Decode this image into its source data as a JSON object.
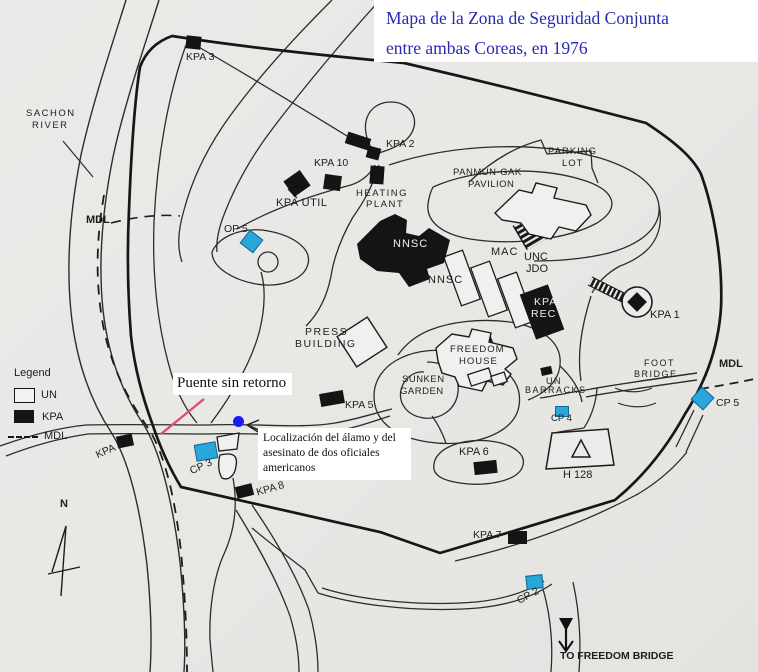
{
  "title": {
    "line1": "Mapa de la Zona de Seguridad Conjunta",
    "line2": "entre ambas Coreas, en 1976"
  },
  "legend": {
    "heading": "Legend",
    "un": "UN",
    "kpa": "KPA",
    "mdl": "MDL"
  },
  "compass": {
    "north": "N"
  },
  "annotations": {
    "bridge_label": "Puente sin retorno",
    "incident_line1": "Localización del álamo y del",
    "incident_line2": "asesinato de dos oficiales",
    "incident_line3": "americanos"
  },
  "labels": {
    "kpa1": "KPA 1",
    "kpa2": "KPA 2",
    "kpa3": "KPA 3",
    "kpa4": "KPA 4",
    "kpa5": "KPA 5",
    "kpa6": "KPA 6",
    "kpa7": "KPA 7",
    "kpa8": "KPA 8",
    "kpa10": "KPA 10",
    "kpa_util": "KPA UTIL",
    "op5": "OP 5",
    "cp2": "CP 2",
    "cp3": "CP 3",
    "cp4": "CP 4",
    "cp5": "CP 5",
    "sachon1": "SACHON",
    "sachon2": "RIVER",
    "mdl_west": "MDL",
    "mdl_east": "MDL",
    "heating1": "HEATING",
    "heating2": "PLANT",
    "panmun1": "PANMUN-GAK",
    "panmun2": "PAVILION",
    "parking1": "PARKING",
    "parking2": "LOT",
    "nnsc_white": "NNSC",
    "nnsc_black": "NNSC",
    "mac": "MAC",
    "unc1": "UNC",
    "unc2": "JDO",
    "kparec1": "KPA",
    "kparec2": "REC",
    "press1": "PRESS",
    "press2": "BUILDING",
    "freedom1": "FREEDOM",
    "freedom2": "HOUSE",
    "sunken1": "SUNKEN",
    "sunken2": "GARDEN",
    "foot1": "FOOT",
    "foot2": "BRIDGE",
    "unb1": "UN",
    "unb2": "BARRACKS",
    "h128": "H 128",
    "to_freedom_bridge": "TO FREEDOM BRIDGE"
  },
  "colors": {
    "title_text": "#2929b2",
    "un_marker_blue": "#2aa7da",
    "incident_dot_blue": "#1c1cf0",
    "bridge_highlight_pink": "#df4a7e",
    "kpa_marker_black": "#141414",
    "paper": "#e8e7e4",
    "ink": "#222222"
  }
}
